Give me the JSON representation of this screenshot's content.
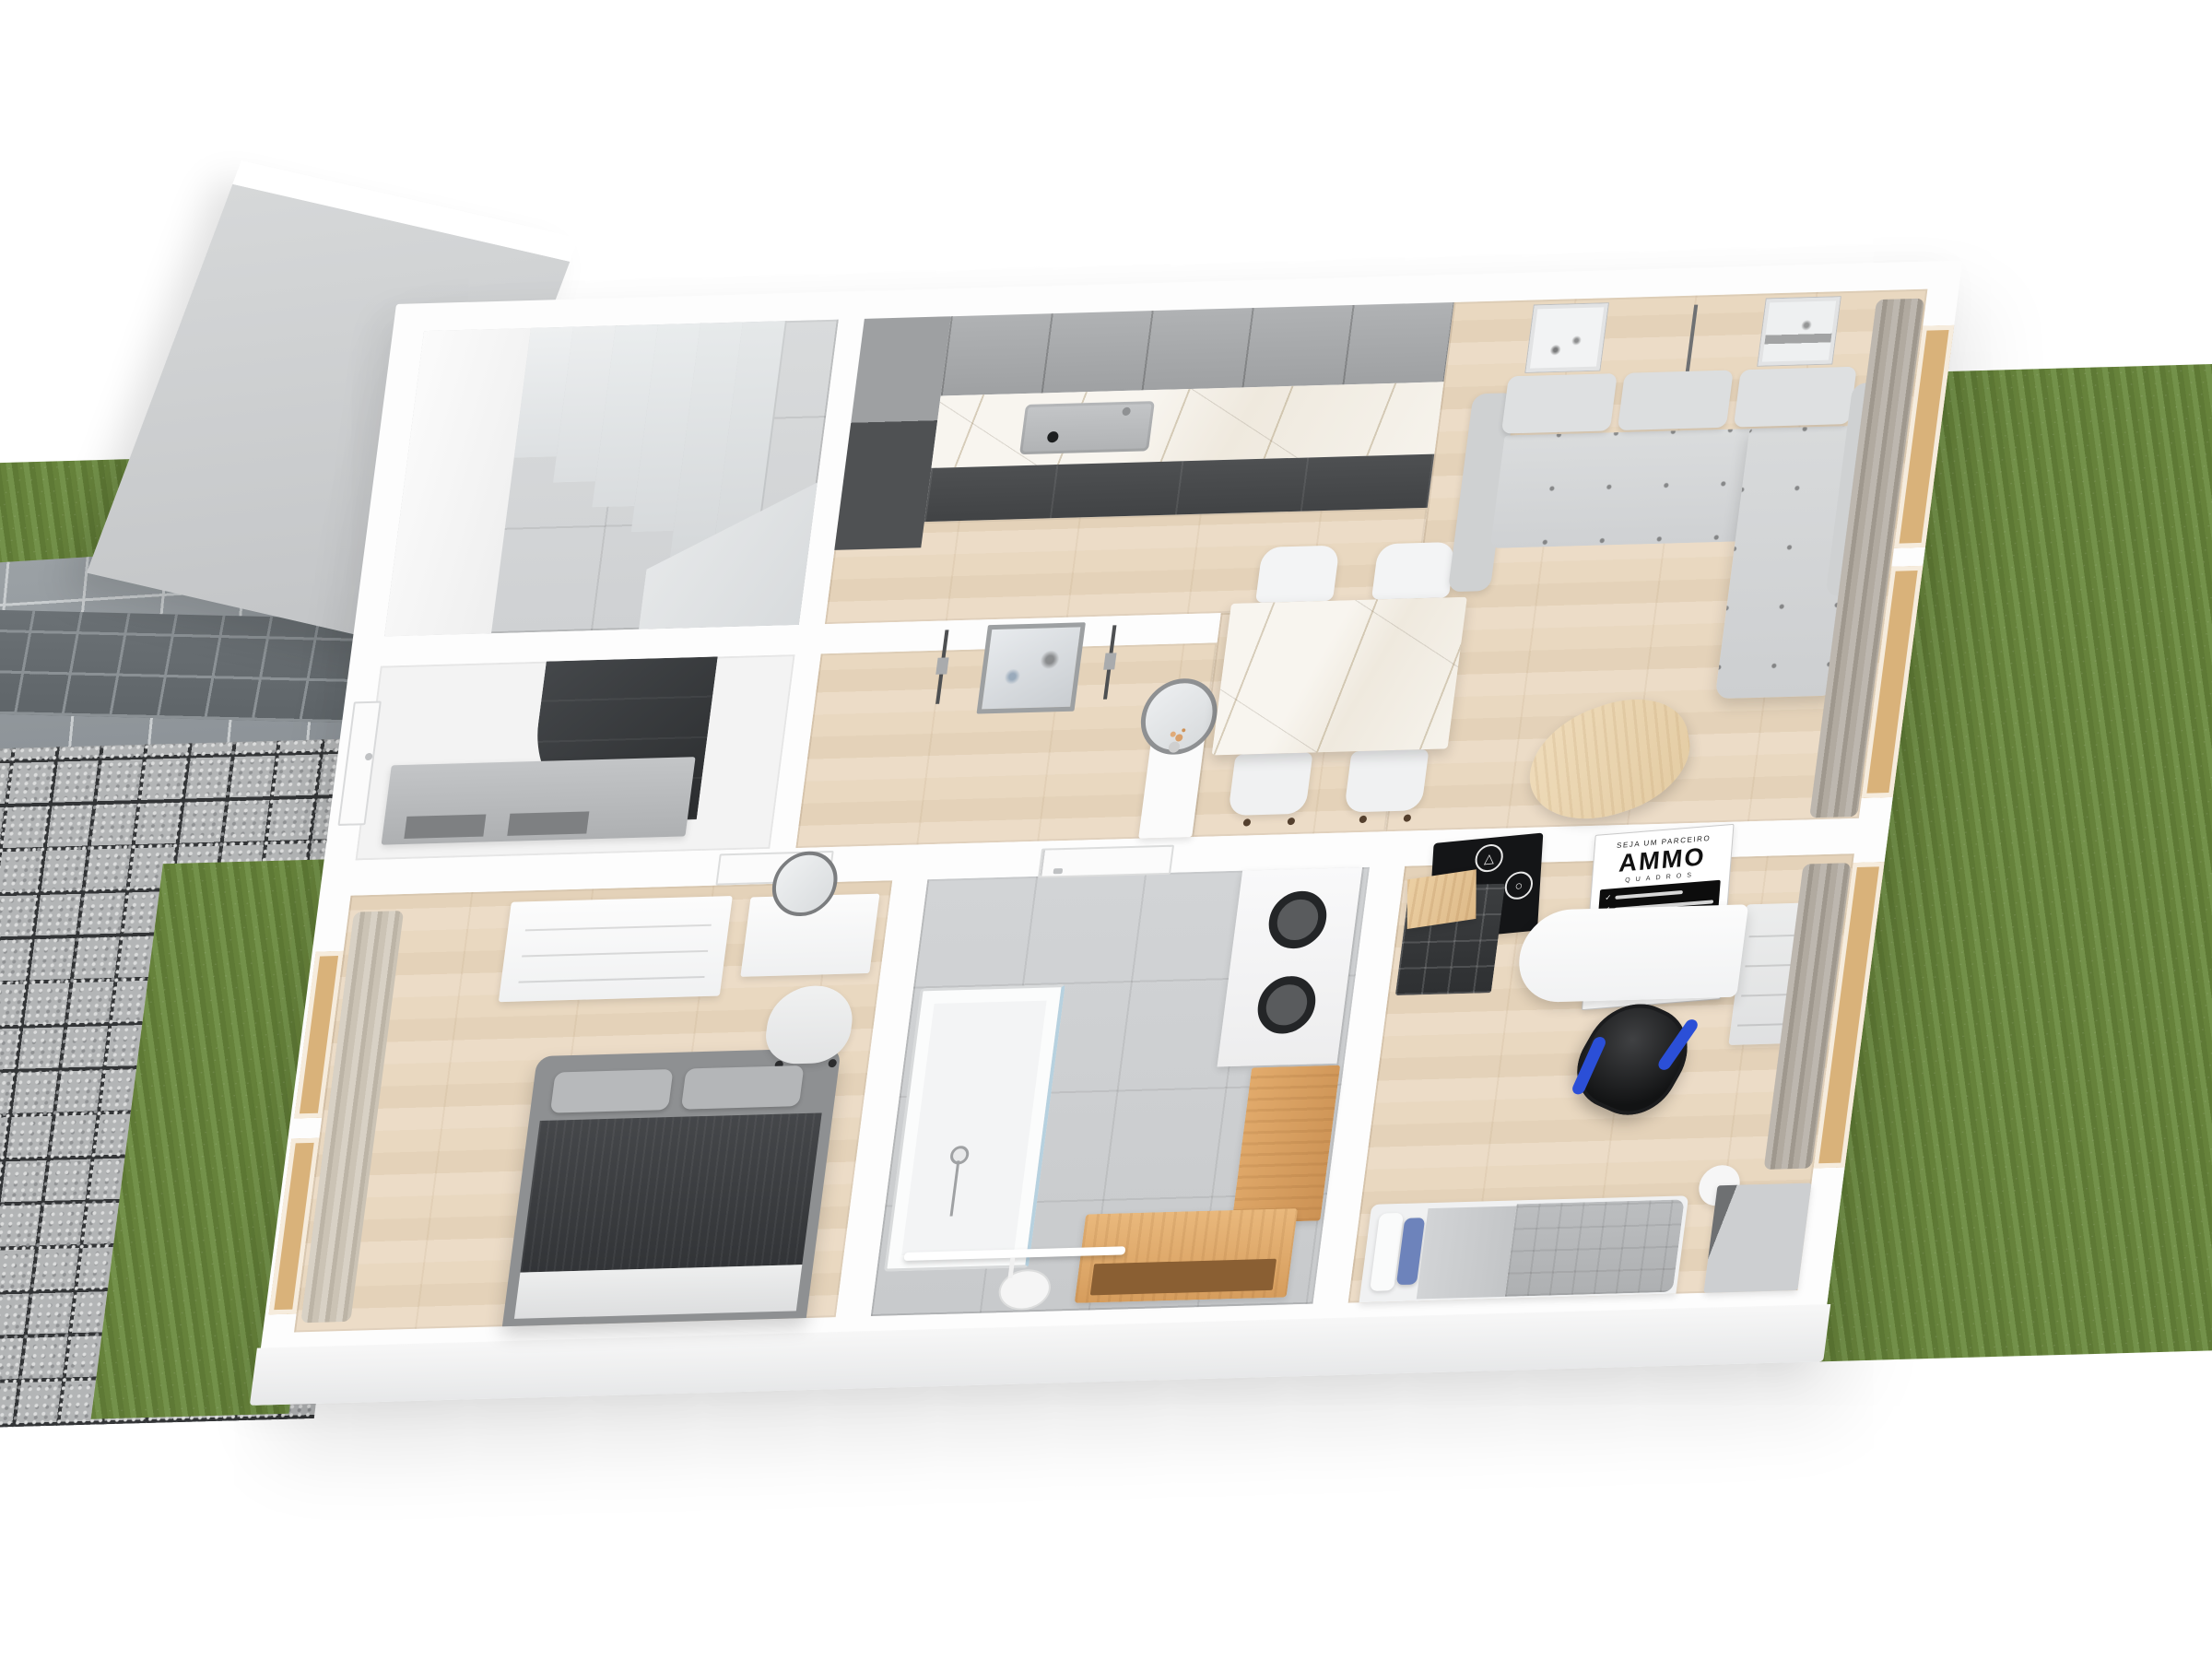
{
  "scene": {
    "render_type": "3d-floorplan-cutaway",
    "background": "#ffffff",
    "rooms": [
      "staircase",
      "entry-hall",
      "hallway",
      "kitchen",
      "dining-area",
      "living-room",
      "bathroom",
      "master-bedroom",
      "office-bedroom"
    ]
  },
  "outdoor": {
    "grass_color": "#6d8a41",
    "driveway_paver_color": "#9aa0a4",
    "walkway_paver_color": "#6b7175",
    "gravel_grid_color": "#323436",
    "gravel_fill_color": "#b3b5b6"
  },
  "palette": {
    "wood_floor": "#e7d7c2",
    "hall_tile": "#d5d7d8",
    "bath_tile": "#ccced0",
    "marble": "#f5f2ec",
    "upper_cabinet_gray": "#a8aaac",
    "base_cabinet_dark": "#4b4d4f",
    "tall_cabinet": "#5f6163",
    "sofa_gray": "#d9dbdc",
    "coffee_table_wood": "#ead3ae",
    "bed_blanket_dark": "#3f4143",
    "bed_frame_gray": "#8e9092",
    "curtain_beige": "#cdc6ba",
    "curtain_gray": "#aaa49a",
    "accent_wood": "#d89f5e",
    "gaming_chair_blue": "#2b4fd7",
    "pillow_blue": "#6d83bb",
    "wardrobe_gray": "#caccce"
  },
  "posters": {
    "gamepad": {
      "glyphs": {
        "top": "△",
        "right": "○",
        "bottom": "✕",
        "left": "□"
      }
    },
    "ammo": {
      "header": "SEJA UM PARCEIRO",
      "brand": "AMMO",
      "sub": "QUADROS",
      "bullet_check": "✓",
      "footer": "www.ammoquadros.com.br"
    }
  }
}
